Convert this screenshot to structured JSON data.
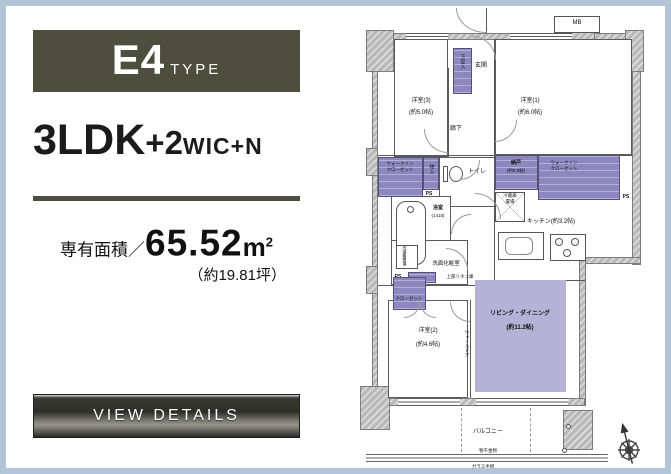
{
  "colors": {
    "accent_olive": "#4e4e3f",
    "border_blue": "#b3c3d8",
    "closet_purple": "#8d87c0",
    "living_purple": "#b6b1d6"
  },
  "panel": {
    "type_main": "E4",
    "type_suffix": "TYPE",
    "layout_main": "3LDK",
    "layout_plus2": "+2",
    "layout_wic": "WIC",
    "layout_plusn": "+N",
    "area_label": "専有面積／",
    "area_value": "65.52",
    "area_unit": "m",
    "area_unit_sup": "2",
    "area_tsubo": "（約19.81坪）",
    "view_details": "VIEW DETAILS"
  },
  "floorplan": {
    "labels": {
      "mb": "MB",
      "genkan": "玄関",
      "shoes": "下足入",
      "room3_name": "洋室(3)",
      "room3_size": "(約5.0帖)",
      "room1_name": "洋室(1)",
      "room1_size": "(約6.0帖)",
      "hallway": "廊下",
      "wic_left": "ウォークイン\nクローゼット",
      "small_storage": "物入",
      "ps": "PS",
      "toilet": "トイレ",
      "nando_name": "納戸",
      "nando_size": "(約0.8帖)",
      "wic_right": "ウォークイン\nクローゼット",
      "fridge": "冷蔵庫\n置場",
      "bath_name": "浴室",
      "bath_size": "(1418)",
      "kitchen": "キッチン(約3.2帖)",
      "washroom": "洗面化粧室",
      "washer": "洗濯機置場",
      "linen_note": "上部リネン庫",
      "closet": "クローゼット",
      "room2_name": "洋室(2)",
      "room2_size": "(約4.6帖)",
      "living_name": "リビング・ダイニング",
      "living_size": "(約11.2帖)",
      "wall_door": "ウォールドア",
      "balcony": "バルコニー",
      "laundry_fitting": "物干金物",
      "glass_rail": "ガラス手摺"
    }
  }
}
